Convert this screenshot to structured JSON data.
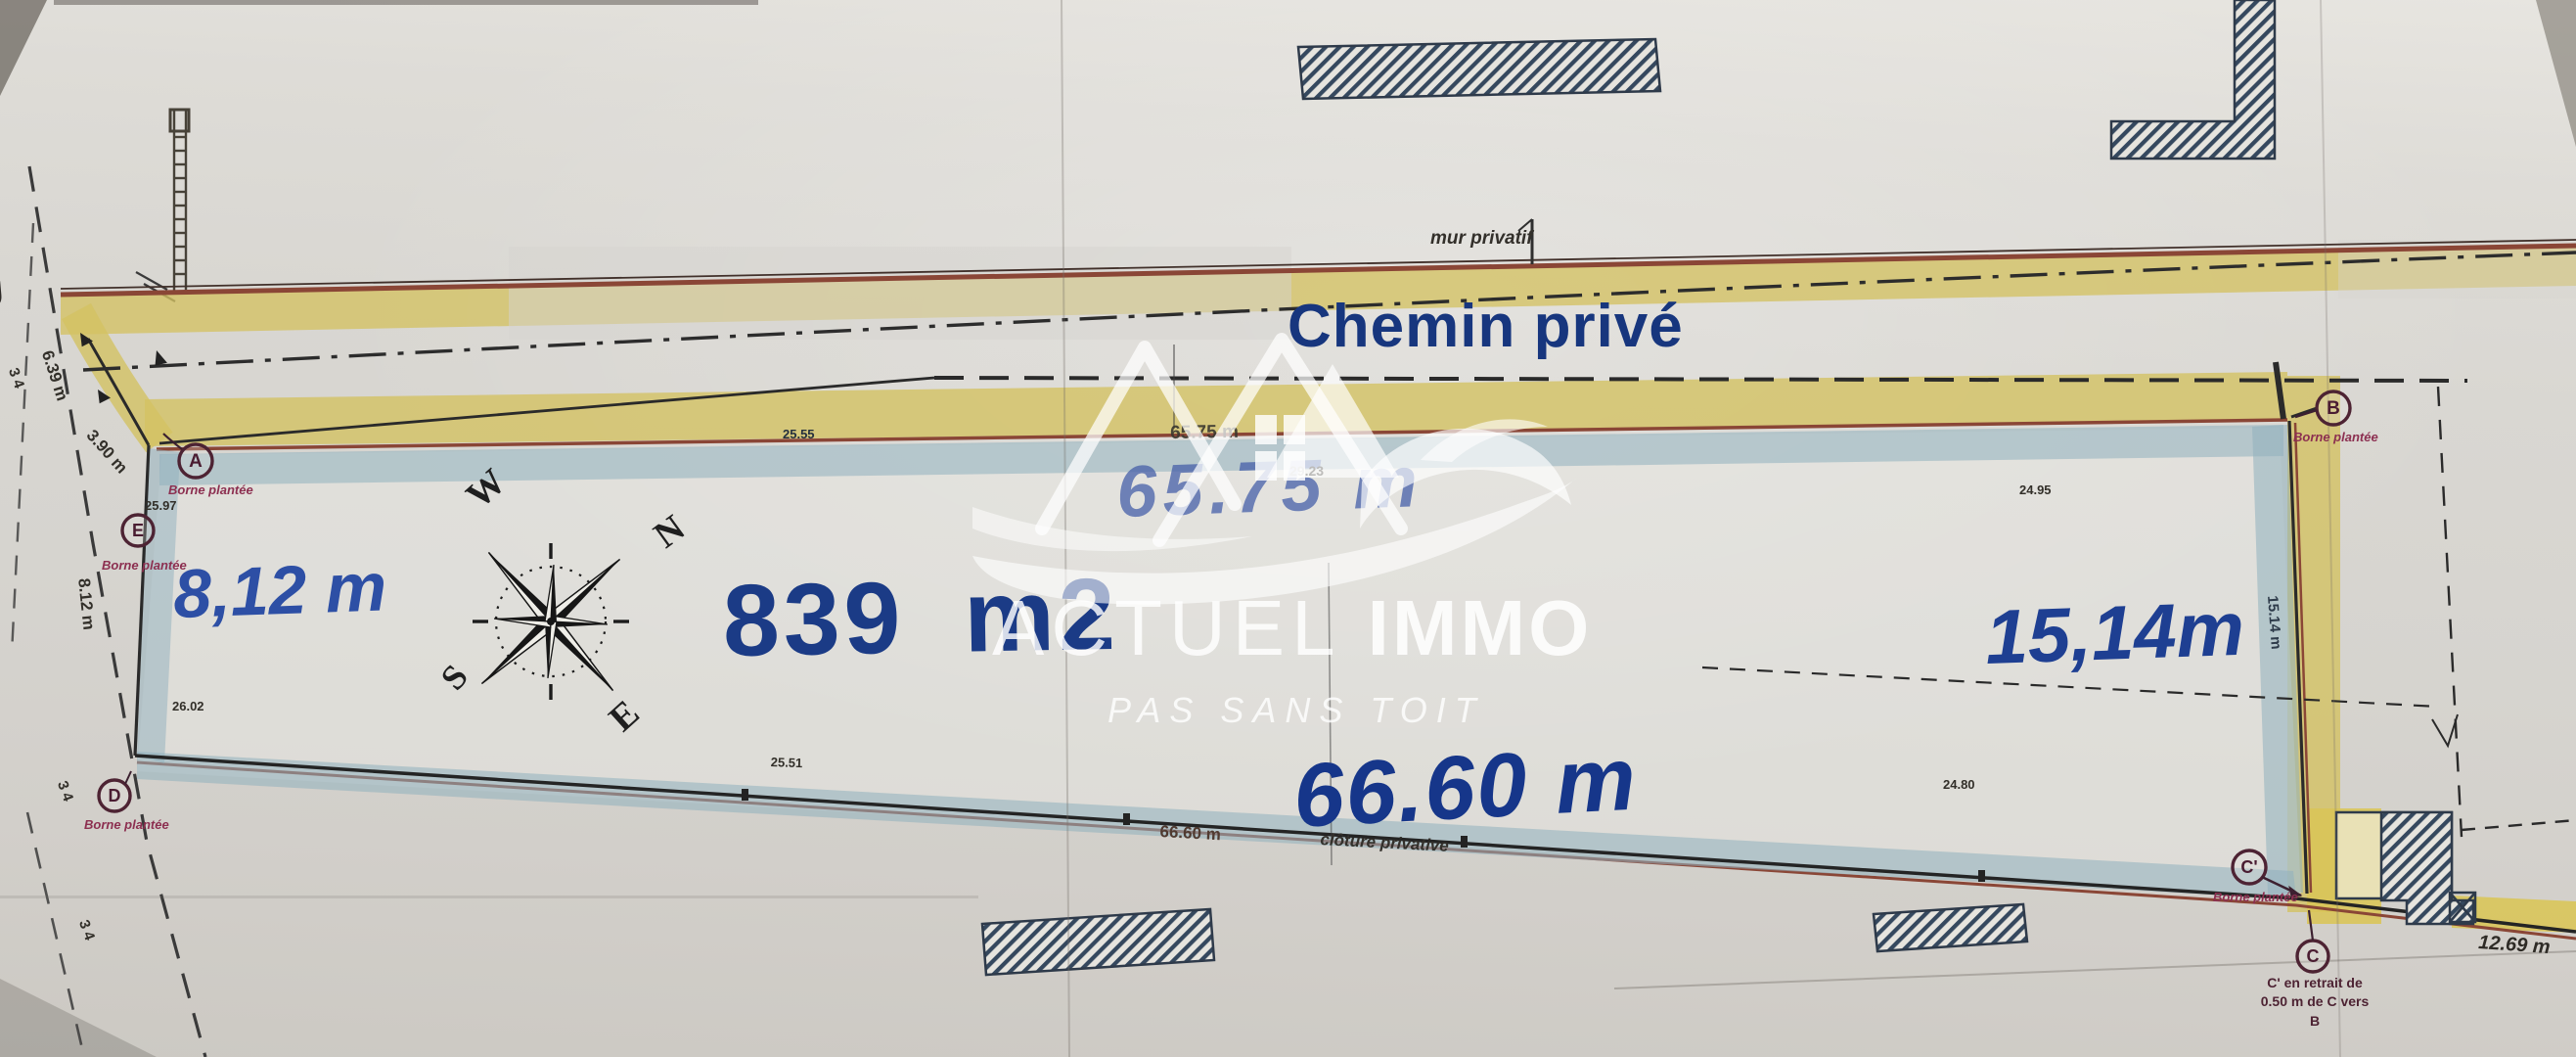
{
  "labels": {
    "street": "Rue",
    "path": "Chemin privé",
    "wall": "mur privatif",
    "fence": "clôture privative",
    "area": "839 m2",
    "north_dim_big": "65.75 m",
    "north_dim_small": "65.75 m",
    "south_dim_big": "66.60 m",
    "south_dim_small": "66.60 m",
    "west_dim_big": "8,12 m",
    "east_dim_big": "15,14m",
    "southeast_dim": "12.69 m"
  },
  "markers": [
    {
      "id": "A",
      "label": "Borne plantée"
    },
    {
      "id": "E",
      "label": "Borne plantée"
    },
    {
      "id": "D",
      "label": "Borne plantée"
    },
    {
      "id": "B",
      "label": "Borne plantée"
    },
    {
      "id": "C'",
      "label": "Borne plantée"
    },
    {
      "id": "C",
      "label": ""
    }
  ],
  "note_c": {
    "line1": "C' en retrait de",
    "line2": "0.50 m de C vers",
    "line3": "B"
  },
  "survey_numbers": {
    "near_a": "25.97",
    "near_d": "26.02",
    "south_mid": "25.51",
    "south_east": "24.80",
    "east_top": "24.95",
    "center": "29.23",
    "north_mid": "25.55"
  },
  "rotated_dims": {
    "street_upper": "6.39 m",
    "corner_curve": "3.90 m",
    "west_side": "8.12 m",
    "east_side": "15.14 m"
  },
  "street_ticks": {
    "t1": "3 4",
    "t2": "3 4",
    "t3": "3 4"
  },
  "compass": {
    "n": "N",
    "e": "E",
    "s": "S",
    "w": "W"
  },
  "watermark": {
    "brand_thin": "ACTUEL",
    "brand_bold": "IMMO",
    "tagline": "PAS SANS TOIT"
  },
  "colors": {
    "plan_blue": "#17367e",
    "dim_blue": "#2d4fa5",
    "faded_blue": "#5c74b4",
    "path_yellow": "#d3c263",
    "wall_red": "#8a4636",
    "band_blue": "#8fb0bd",
    "marker_maroon": "#7c2a48",
    "paper": "#d8d6d1"
  }
}
